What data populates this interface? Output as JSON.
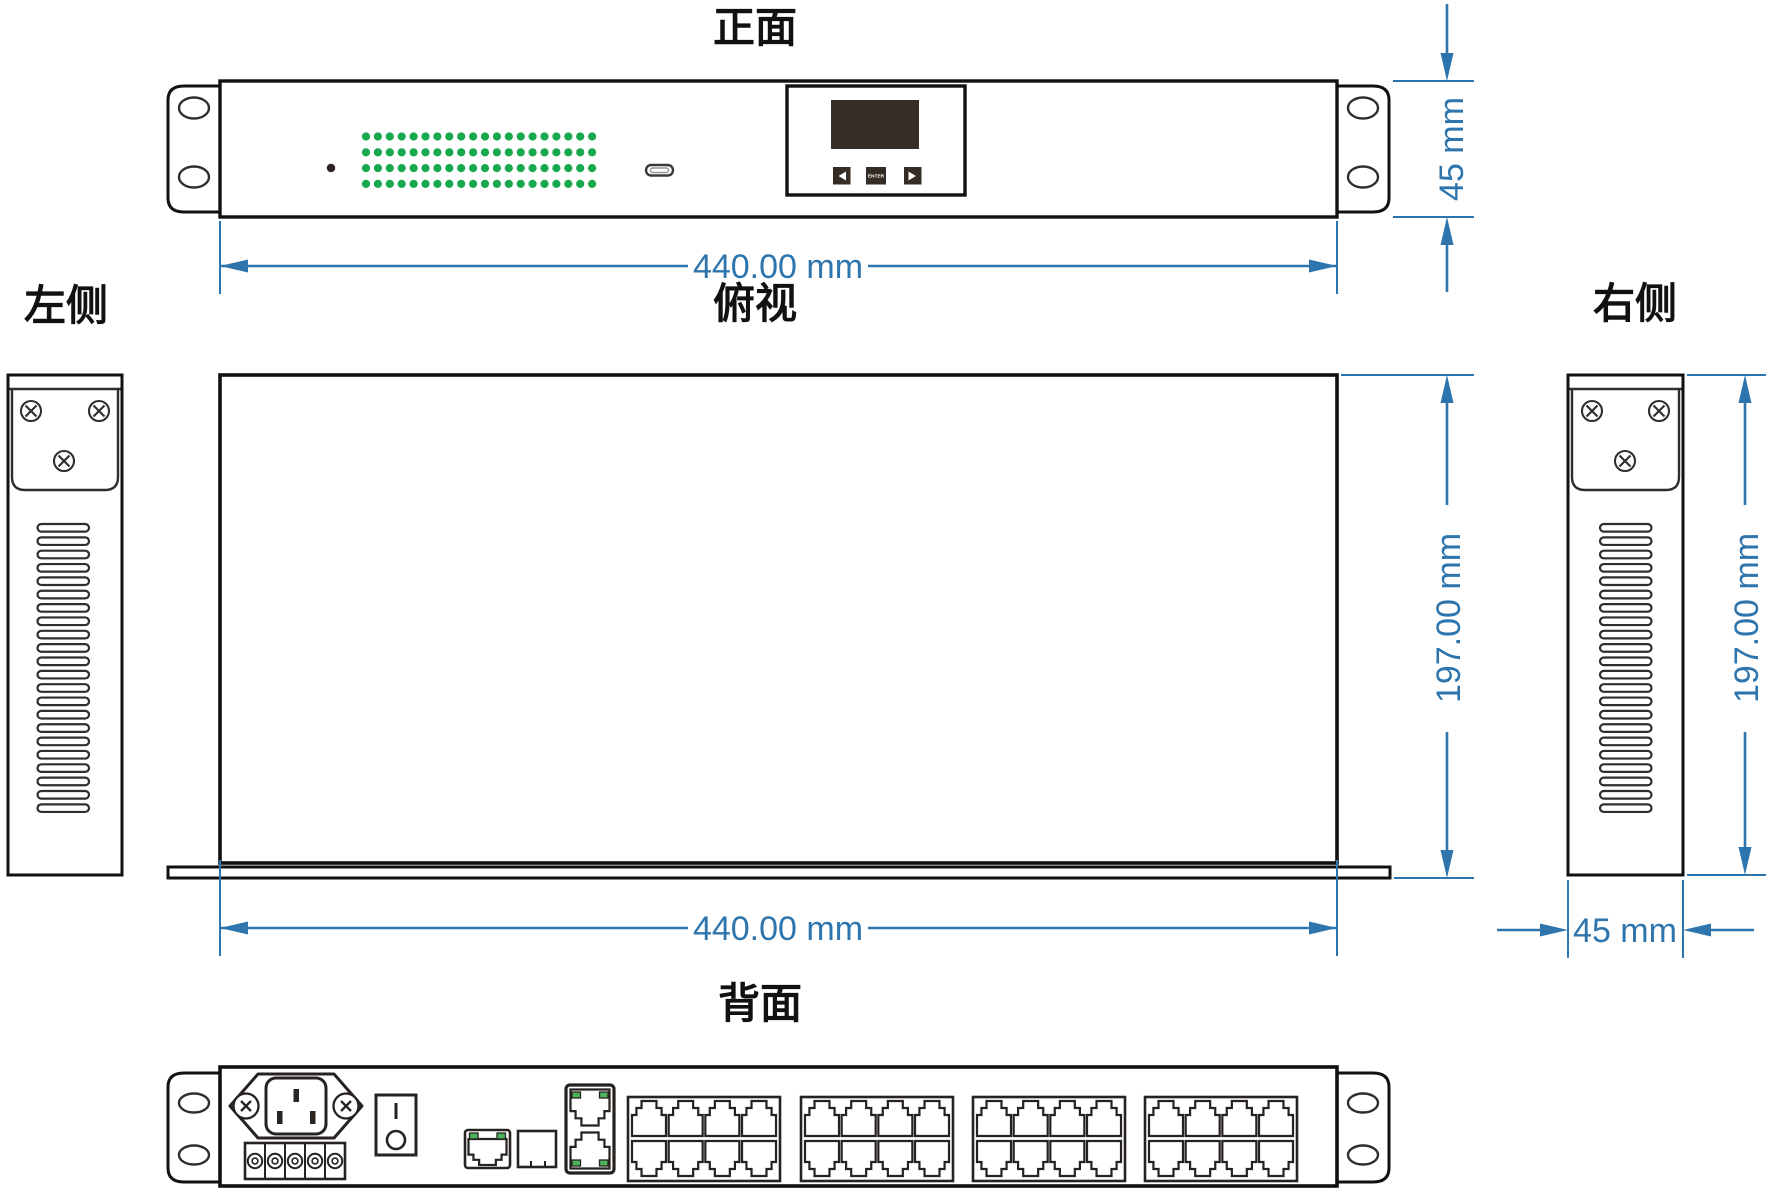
{
  "titles": {
    "front": "正面",
    "left_side": "左侧",
    "top": "俯视",
    "right_side": "右侧",
    "rear": "背面"
  },
  "dimensions": {
    "front_width": "440.00 mm",
    "front_height": "45 mm",
    "top_width": "440.00 mm",
    "top_depth": "197.00 mm",
    "right_depth": "197.00 mm",
    "right_width": "45 mm"
  },
  "front_panel": {
    "enter_button": "ENTER",
    "led_grid": {
      "rows": 4,
      "cols": 20,
      "color": "#18a84e"
    },
    "status_led_color": "#2b2420",
    "screen_color": "#362d26"
  },
  "side_panels": {
    "vent_slat_count": 22,
    "screw_count": 3
  },
  "rear_panel": {
    "rj45_bank_count": 4,
    "ports_per_bank": 8,
    "terminal_screw_count": 5,
    "led_color": "#4db35a"
  },
  "colors": {
    "dimension": "#2e75ad",
    "outline": "#111111"
  }
}
